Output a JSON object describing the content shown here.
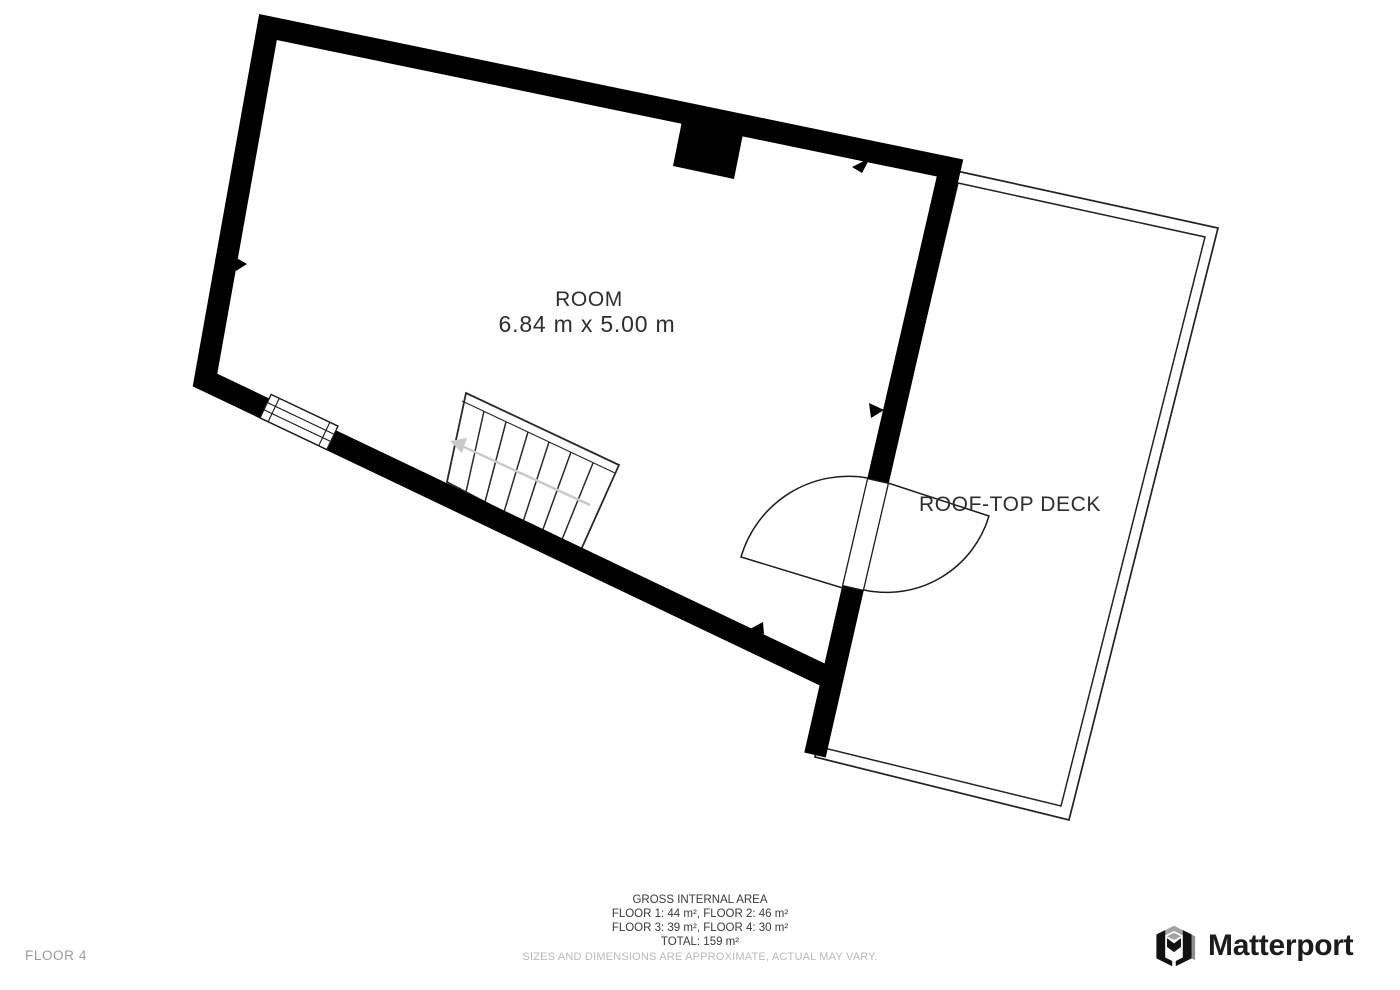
{
  "plan": {
    "room_label": "ROOM",
    "room_dimensions": "6.84 m x 5.00 m",
    "deck_label": "ROOF-TOP DECK"
  },
  "footer": {
    "floor_indicator": "FLOOR 4",
    "gross_title": "GROSS INTERNAL AREA",
    "area_line_1": "FLOOR 1: 44 m², FLOOR 2: 46 m²",
    "area_line_2": "FLOOR 3: 39 m², FLOOR 4: 30 m²",
    "total_line": "TOTAL: 159 m²",
    "disclaimer": "SIZES AND DIMENSIONS ARE APPROXIMATE, ACTUAL MAY VARY."
  },
  "branding": {
    "wordmark": "Matterport"
  },
  "colors": {
    "wall": "#000000",
    "thin_line": "#1d1d1d",
    "plan_text": "#2e2e2e",
    "muted_text": "#9b9b9b",
    "faint_text": "#b9b9b9",
    "stair_arrow": "#c9c9c9",
    "logo_text": "#1c1c1e"
  }
}
